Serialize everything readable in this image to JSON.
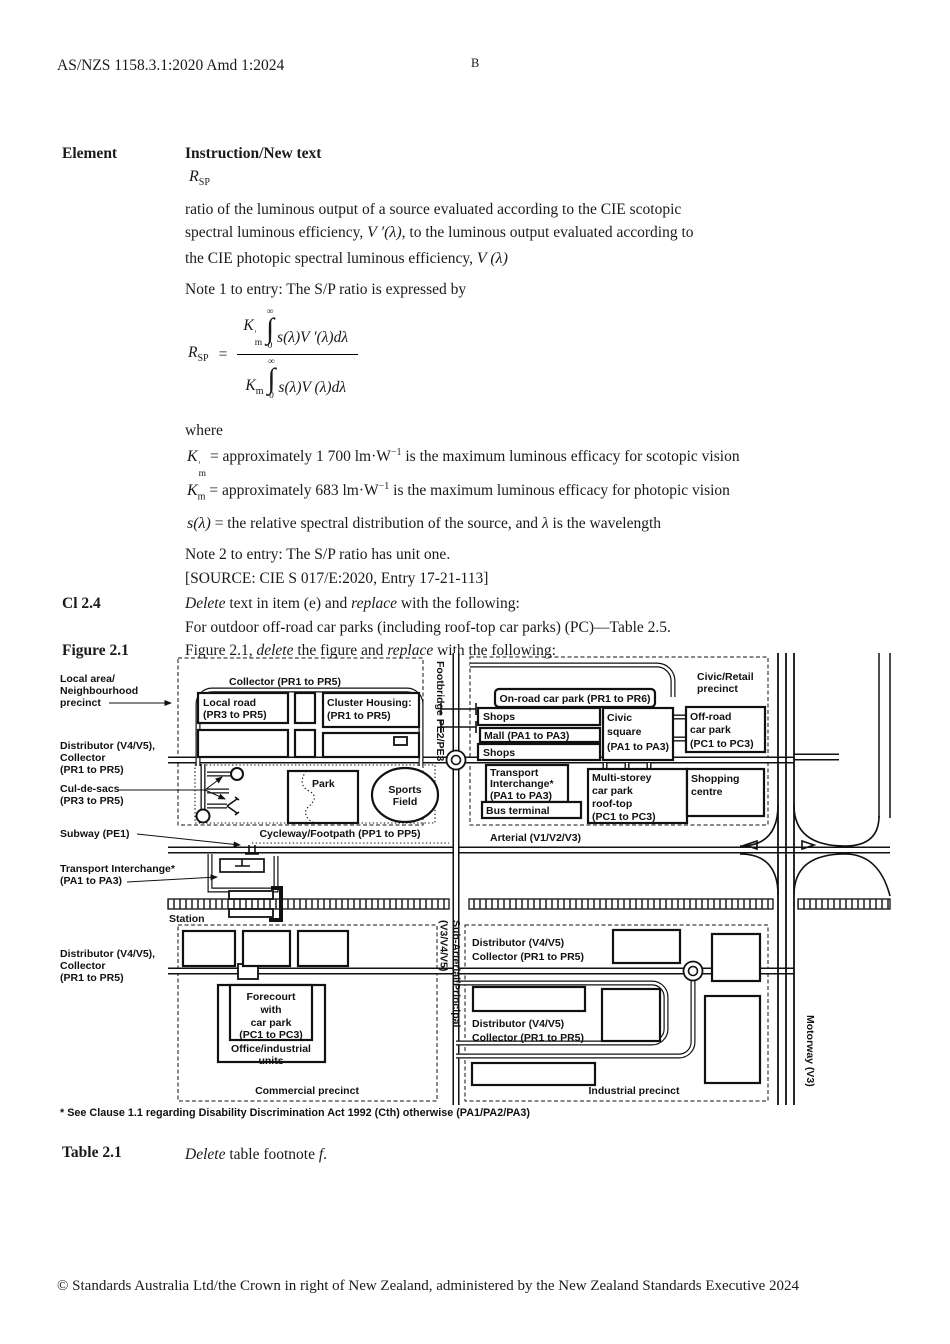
{
  "header": {
    "doc_id": "AS/NZS 1158.3.1:2020 Amd 1:2024",
    "page_marker": "B"
  },
  "table_head": {
    "element": "Element",
    "instruction": "Instruction/New text"
  },
  "rsp": {
    "base": "R",
    "sub": "SP"
  },
  "definition": {
    "line1": "ratio of the luminous output of a source evaluated according to the CIE scotopic",
    "line2_pre": "spectral luminous efficiency, ",
    "line2_math": "V ′(λ)",
    "line2_post": ", to the luminous output evaluated according to",
    "line3_pre": "the CIE photopic spectral luminous efficiency, ",
    "line3_math": "V (λ)"
  },
  "note1": "Note 1 to entry: The S/P ratio is expressed by",
  "formula": {
    "lhs_base": "R",
    "lhs_sub": "SP",
    "eq": "=",
    "num_k": "K",
    "num_k_sup": "'",
    "num_k_sub": "m",
    "num_upper": "∞",
    "num_int": "∫",
    "num_lower": "0",
    "num_body": "s(λ)V ′(λ)dλ",
    "den_k": "K",
    "den_k_sub": "m",
    "den_upper": "∞",
    "den_int": "∫",
    "den_lower": "0",
    "den_body": "s(λ)V (λ)dλ"
  },
  "where_label": "where",
  "defs": {
    "km_s": {
      "sym": "K",
      "sup": "'",
      "sub": "m",
      "mid": " = approximately 1 700 lm·W",
      "exp": "−1",
      "end": " is the maximum luminous efficacy for scotopic vision"
    },
    "km_p": {
      "sym": "K",
      "sub": "m",
      "mid": " = approximately 683 lm·W",
      "exp": "−1",
      "end": " is the maximum luminous efficacy for photopic vision"
    },
    "s_lambda": {
      "sym": "s(λ)",
      "mid": " = the relative spectral distribution of the source, and ",
      "lam": "λ",
      "end": " is the wavelength"
    }
  },
  "note2": "Note 2 to entry: The S/P ratio has unit one.",
  "source": "[SOURCE: CIE S 017/E:2020, Entry 17-21-113]",
  "cl24": {
    "label": "Cl 2.4",
    "w_delete": "Delete",
    "mid": " text in item (e) and ",
    "w_replace": "replace",
    "end": " with the following:",
    "line2": "For outdoor off-road car parks (including roof-top car parks) (PC)—Table 2.5."
  },
  "fig_row": {
    "label": "Figure 2.1",
    "pre": "Figure 2.1, ",
    "w_delete": "delete",
    "mid": " the figure and ",
    "w_replace": "replace",
    "end": " with the following:"
  },
  "figure": {
    "labels_left": {
      "local_area": [
        "Local area/",
        "Neighbourhood",
        "precinct"
      ],
      "distributor_a": [
        "Distributor (V4/V5),",
        "Collector",
        "(PR1 to PR5)"
      ],
      "cul_de_sacs": [
        "Cul-de-sacs",
        "(PR3 to PR5)"
      ],
      "subway": "Subway (PE1)",
      "transport_interchange": [
        "Transport Interchange*",
        "(PA1 to PA3)"
      ],
      "distributor_b": [
        "Distributor (V4/V5),",
        "Collector",
        "(PR1 to PR5)"
      ]
    },
    "map": {
      "collector_top": "Collector (PR1 to PR5)",
      "local_road": [
        "Local road",
        "(PR3 to PR5)"
      ],
      "cluster_housing": [
        "Cluster Housing:",
        "(PR1 to PR5)"
      ],
      "footbridge": "Footbridge PE2/PE3",
      "park": "Park",
      "sports_field": [
        "Sports",
        "Field"
      ],
      "cycleway": "Cycleway/Footpath (PP1 to PP5)",
      "civic_retail": [
        "Civic/Retail",
        "precinct"
      ],
      "onroad_carpark": "On-road car park (PR1 to PR6)",
      "shops_1": "Shops",
      "mall": "Mall (PA1 to PA3)",
      "shops_2": "Shops",
      "civic_square": [
        "Civic",
        "square",
        "(PA1 to PA3)"
      ],
      "offroad_carpark": [
        "Off-road",
        "car park",
        "(PC1 to PC3)"
      ],
      "transport_interchange_box": [
        "Transport",
        "Interchange*",
        "(PA1 to PA3)"
      ],
      "bus_terminal": "Bus terminal",
      "multi_storey": [
        "Multi-storey",
        "car park",
        "roof-top",
        "(PC1 to PC3)"
      ],
      "shopping_centre": [
        "Shopping",
        "centre"
      ],
      "arterial": "Arterial (V1/V2/V3)",
      "station": "Station",
      "sub_arterial": [
        "Sub-Arterial/Principal",
        "(V3/V4/V5)"
      ],
      "distributor_ind_1": [
        "Distributor (V4/V5)",
        "Collector (PR1 to PR5)"
      ],
      "distributor_ind_2": [
        "Distributor (V4/V5)",
        "Collector (PR1 to PR5)"
      ],
      "forecourt": [
        "Forecourt",
        "with",
        "car park",
        "(PC1 to PC3)"
      ],
      "office_units": [
        "Office/industrial",
        "units"
      ],
      "commercial": "Commercial precinct",
      "industrial": "Industrial precinct",
      "motorway": "Motorway (V3)"
    },
    "footnote": "* See Clause 1.1 regarding Disability Discrimination Act 1992 (Cth) otherwise (PA1/PA2/PA3)"
  },
  "table_row": {
    "label": "Table 2.1",
    "w_delete": "Delete",
    "mid": " table footnote ",
    "w_f": "f",
    "end": "."
  },
  "footer": "© Standards Australia Ltd/the Crown in right of New Zealand, administered by the New Zealand Standards Executive 2024"
}
